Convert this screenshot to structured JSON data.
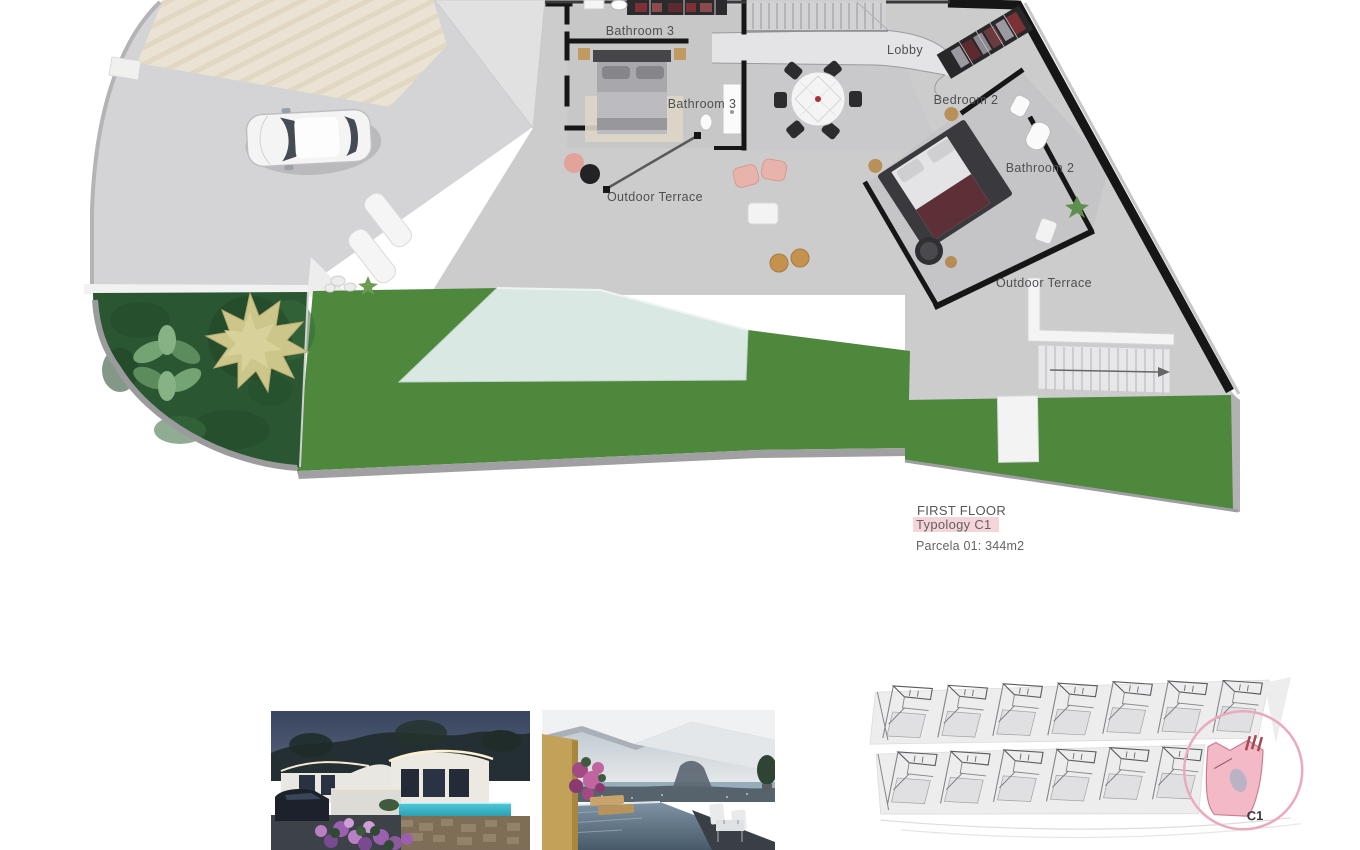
{
  "plan": {
    "labels": {
      "bathroom3_top": "Bathroom 3",
      "bathroom3_mid": "Bathroom 3",
      "lobby": "Lobby",
      "bedroom2": "Bedroom 2",
      "bathroom2": "Bathroom 2",
      "terrace_left": "Outdoor Terrace",
      "terrace_right": "Outdoor Terrace"
    },
    "caption": {
      "floor": "FIRST FLOOR",
      "typology": "Typology C1",
      "parcel": "Parcela 01: 344m2"
    },
    "colors": {
      "lawn": "#4d883c",
      "garden": "#2b5632",
      "pool": "#dae8e3",
      "wall": "#161616",
      "cream_roof": "#eae2d2",
      "typology_highlight": "#f6d5da"
    }
  },
  "site_plan": {
    "unit_label": "C1",
    "unit_fill": "#f4b9c7",
    "circle_stroke": "#eaaabb"
  },
  "photos": {
    "left_label": "villa-night-render",
    "right_label": "terrace-sea-view-render"
  }
}
